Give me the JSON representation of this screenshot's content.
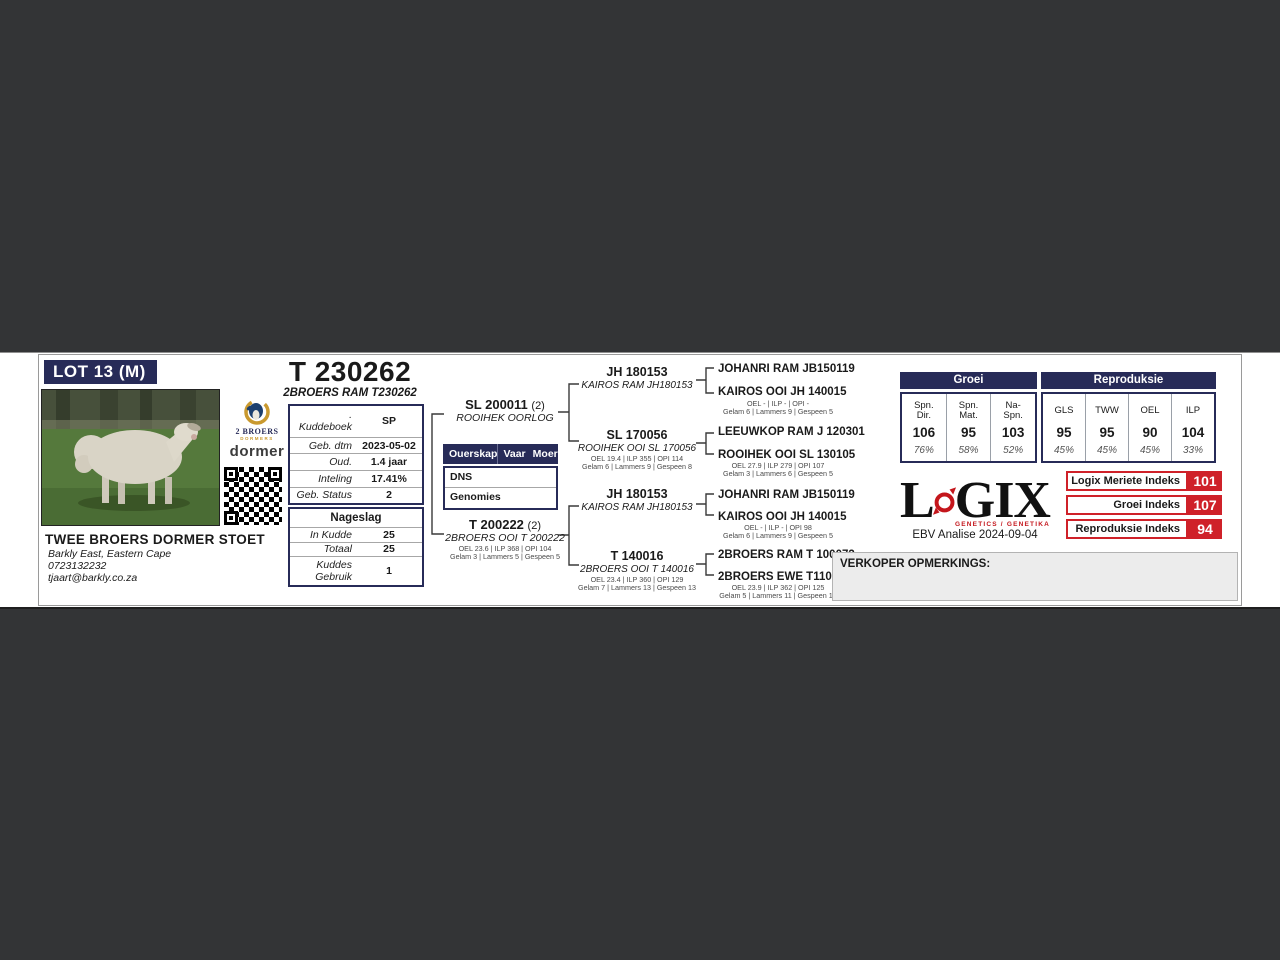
{
  "lot": {
    "label": "LOT 13 (M)"
  },
  "animal": {
    "id_title": "T 230262",
    "name": "2BROERS RAM T230262"
  },
  "breeder": {
    "name": "TWEE BROERS DORMER STOET",
    "location": "Barkly East, Eastern Cape",
    "phone": "0723132232",
    "email": "tjaart@barkly.co.za"
  },
  "logos": {
    "two_broers_label": "2 BROERS",
    "two_broers_sub": "DORMERS",
    "dormer_label": "dormer"
  },
  "details": {
    "rows": [
      {
        "label": ". Kuddeboek",
        "value": "SP"
      },
      {
        "label": "Geb. dtm",
        "value": "2023-05-02"
      },
      {
        "label": "Oud.",
        "value": "1.4 jaar"
      },
      {
        "label": "Inteling",
        "value": "17.41%"
      },
      {
        "label": "Geb. Status",
        "value": "2"
      }
    ]
  },
  "nageslag": {
    "title": "Nageslag",
    "rows": [
      {
        "label": "In Kudde",
        "value": "25"
      },
      {
        "label": "Totaal",
        "value": "25"
      },
      {
        "label": "Kuddes Gebruik",
        "value": "1"
      }
    ]
  },
  "ouerskap": {
    "headers": [
      "Ouerskap",
      "Vaar",
      "Moer"
    ],
    "rows": [
      "DNS",
      "Genomies"
    ]
  },
  "pedigree": {
    "sire": {
      "id": "SL 200011",
      "suffix": "(2)",
      "name": "ROOIHEK OORLOG"
    },
    "dam": {
      "id": "T 200222",
      "suffix": "(2)",
      "name": "2BROERS OOI T 200222",
      "stats1": "OEL 23.6 | ILP 368 | OPI 104",
      "stats2": "Gelam 3 | Lammers 5 | Gespeen 5"
    },
    "grandparents": [
      {
        "id": "JH 180153",
        "name": "KAIROS RAM JH180153"
      },
      {
        "id": "SL 170056",
        "name": "ROOIHEK OOI SL 170056",
        "stats1": "OEL 19.4 | ILP 355 | OPI 114",
        "stats2": "Gelam 6 | Lammers 9 | Gespeen 8"
      },
      {
        "id": "JH 180153",
        "name": "KAIROS RAM JH180153"
      },
      {
        "id": "T 140016",
        "name": "2BROERS OOI T 140016",
        "stats1": "OEL 23.4 | ILP 360 | OPI 129",
        "stats2": "Gelam 7 | Lammers 13 | Gespeen 13"
      }
    ],
    "great_grandparents": [
      {
        "name": "JOHANRI RAM JB150119"
      },
      {
        "name": "KAIROS OOI JH 140015",
        "stats1": "OEL - | ILP - | OPI -",
        "stats2": "Gelam 6 | Lammers 9 | Gespeen 5"
      },
      {
        "name": "LEEUWKOP RAM J 120301"
      },
      {
        "name": "ROOIHEK OOI SL 130105",
        "stats1": "OEL 27.9 | ILP 279 | OPI 107",
        "stats2": "Gelam 3 | Lammers 6 | Gespeen 5"
      },
      {
        "name": "JOHANRI RAM JB150119"
      },
      {
        "name": "KAIROS OOI JH 140015",
        "stats1": "OEL - | ILP - | OPI 98",
        "stats2": "Gelam 6 | Lammers 9 | Gespeen 5"
      },
      {
        "name": "2BROERS RAM T 100073"
      },
      {
        "name": "2BROERS EWE T110068",
        "stats1": "OEL 23.9 | ILP 362 | OPI 125",
        "stats2": "Gelam 5 | Lammers 11 | Gespeen 10"
      }
    ]
  },
  "ebv": {
    "groei": {
      "title": "Groei",
      "cells": [
        {
          "label1": "Spn.",
          "label2": "Dir.",
          "value": "106",
          "acc": "76%"
        },
        {
          "label1": "Spn.",
          "label2": "Mat.",
          "value": "95",
          "acc": "58%"
        },
        {
          "label1": "Na-",
          "label2": "Spn.",
          "value": "103",
          "acc": "52%"
        }
      ]
    },
    "repro": {
      "title": "Reproduksie",
      "cells": [
        {
          "label1": "GLS",
          "value": "95",
          "acc": "45%"
        },
        {
          "label1": "TWW",
          "value": "95",
          "acc": "45%"
        },
        {
          "label1": "OEL",
          "value": "90",
          "acc": "45%"
        },
        {
          "label1": "ILP",
          "value": "104",
          "acc": "33%"
        }
      ]
    }
  },
  "logix": {
    "letter_l": "L",
    "letters_gix": "GIX",
    "subtitle": "GENETICS / GENETIKA",
    "analysis": "EBV Analise 2024-09-04"
  },
  "indexes": [
    {
      "label": "Logix Meriete Indeks",
      "value": "101"
    },
    {
      "label": "Groei Indeks",
      "value": "107"
    },
    {
      "label": "Reproduksie Indeks",
      "value": "94"
    }
  ],
  "verkoper": {
    "label": "VERKOPER OPMERKINGS:"
  },
  "colors": {
    "navy": "#272b58",
    "red": "#cf2129",
    "background": "#333436"
  }
}
